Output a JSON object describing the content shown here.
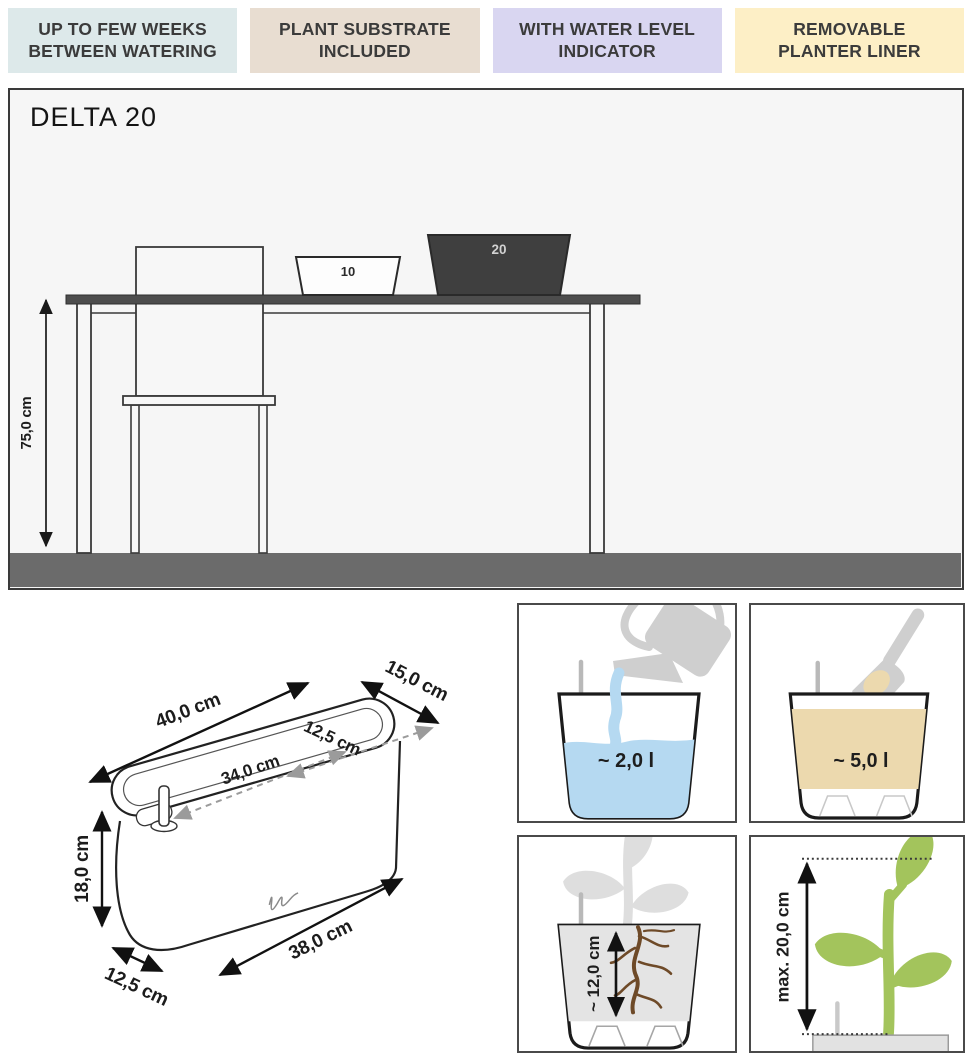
{
  "banners": [
    {
      "label": "UP TO FEW WEEKS\nBETWEEN WATERING",
      "bg": "#dde9ea"
    },
    {
      "label": "PLANT SUBSTRATE\nINCLUDED",
      "bg": "#e8ddd1"
    },
    {
      "label": "WITH WATER LEVEL\nINDICATOR",
      "bg": "#d9d6f1"
    },
    {
      "label": "REMOVABLE\nPLANTER LINER",
      "bg": "#fdefc6"
    }
  ],
  "main": {
    "title": "DELTA 20",
    "table_height": "75,0 cm",
    "small_planter_label": "10",
    "large_planter_label": "20"
  },
  "dims": {
    "top_length": "40,0 cm",
    "top_width": "15,0 cm",
    "inner_width": "12,5 cm",
    "inner_length": "34,0 cm",
    "height": "18,0 cm",
    "base_width": "12,5 cm",
    "base_length": "38,0 cm"
  },
  "panels": {
    "water_volume": "~ 2,0 l",
    "substrate_volume": "~ 5,0 l",
    "root_depth": "~ 12,0 cm",
    "max_plant_height": "max. 20,0 cm"
  },
  "colors": {
    "water_blue": "#b5d9f1",
    "substrate_tan": "#ecd9ae",
    "plant_green": "#a3c45c",
    "floor_grey": "#6b6b6b",
    "planter_dark": "#3f3f3f",
    "silhouette_grey": "#cfcfcf",
    "roots_brown": "#6e4a28"
  }
}
